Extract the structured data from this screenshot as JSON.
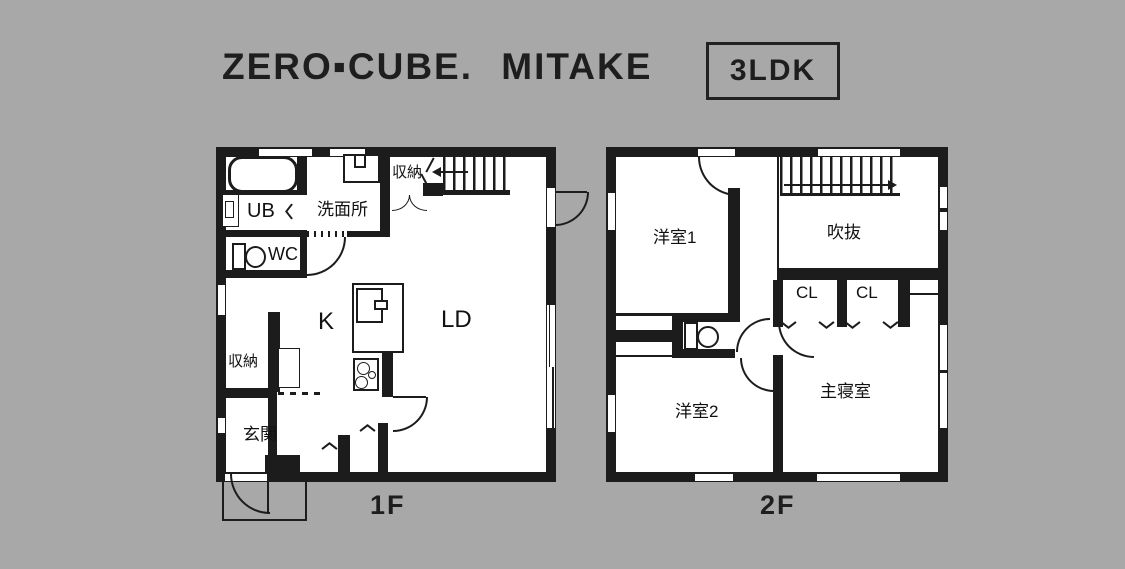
{
  "header": {
    "title": "ZERO▪CUBE. MITAKE",
    "badge": "3LDK"
  },
  "f1": {
    "label": "1F",
    "ub": "UB",
    "washroom": "洗面所",
    "storage_top": "収納",
    "wc": "WC",
    "kitchen": "K",
    "living": "LD",
    "storage_bottom": "収納",
    "entrance": "玄関"
  },
  "f2": {
    "label": "2F",
    "room1": "洋室1",
    "void": "吹抜",
    "closet1": "CL",
    "closet2": "CL",
    "master": "主寝室",
    "room2": "洋室2"
  },
  "colors": {
    "background": "#a8a8a8",
    "ink": "#1c1c1c",
    "floor": "#ffffff"
  }
}
